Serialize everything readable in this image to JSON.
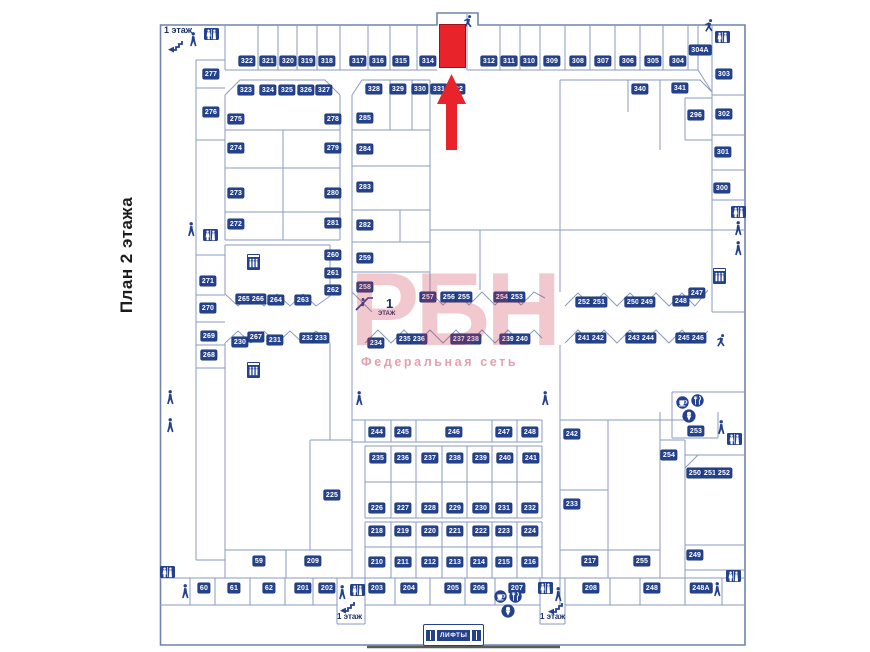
{
  "page": {
    "vertical_title": "План 2 этажа"
  },
  "watermark": {
    "logo_text": "РБН",
    "subtitle": "Федеральная сеть",
    "color": "#c92d46"
  },
  "highlight": {
    "unit_color": "#e8232a",
    "arrow_color": "#e8232a"
  },
  "label_style": {
    "bg": "#24418e",
    "fg": "#ffffff"
  },
  "lifts": {
    "label": "ЛИФТЫ"
  },
  "floor_texts": [
    {
      "t": "1 этаж",
      "x": 164,
      "y": 26,
      "size": 9
    },
    {
      "t": "1",
      "x": 386,
      "y": 297,
      "size": 13
    },
    {
      "t": "ЭТАЖ",
      "x": 378,
      "y": 311,
      "size": 6
    },
    {
      "t": "1 этаж",
      "x": 337,
      "y": 613,
      "size": 8
    },
    {
      "t": "1 этаж",
      "x": 540,
      "y": 613,
      "size": 8
    }
  ],
  "units": [
    {
      "n": "322",
      "x": 247,
      "y": 61
    },
    {
      "n": "321",
      "x": 268,
      "y": 61
    },
    {
      "n": "320",
      "x": 288,
      "y": 61
    },
    {
      "n": "319",
      "x": 307,
      "y": 61
    },
    {
      "n": "318",
      "x": 327,
      "y": 61
    },
    {
      "n": "317",
      "x": 358,
      "y": 61
    },
    {
      "n": "316",
      "x": 378,
      "y": 61
    },
    {
      "n": "315",
      "x": 401,
      "y": 61
    },
    {
      "n": "314",
      "x": 428,
      "y": 61
    },
    {
      "n": "312",
      "x": 489,
      "y": 61
    },
    {
      "n": "311",
      "x": 509,
      "y": 61
    },
    {
      "n": "310",
      "x": 529,
      "y": 61
    },
    {
      "n": "309",
      "x": 552,
      "y": 61
    },
    {
      "n": "308",
      "x": 578,
      "y": 61
    },
    {
      "n": "307",
      "x": 603,
      "y": 61
    },
    {
      "n": "306",
      "x": 628,
      "y": 61
    },
    {
      "n": "305",
      "x": 653,
      "y": 61
    },
    {
      "n": "304",
      "x": 678,
      "y": 61
    },
    {
      "n": "304A",
      "x": 700,
      "y": 50
    },
    {
      "n": "323",
      "x": 246,
      "y": 90
    },
    {
      "n": "324",
      "x": 268,
      "y": 90
    },
    {
      "n": "325",
      "x": 287,
      "y": 90
    },
    {
      "n": "326",
      "x": 306,
      "y": 90
    },
    {
      "n": "327",
      "x": 324,
      "y": 90
    },
    {
      "n": "328",
      "x": 374,
      "y": 89
    },
    {
      "n": "329",
      "x": 398,
      "y": 89
    },
    {
      "n": "330",
      "x": 420,
      "y": 89
    },
    {
      "n": "331",
      "x": 439,
      "y": 89
    },
    {
      "n": "332",
      "x": 457,
      "y": 89
    },
    {
      "n": "340",
      "x": 640,
      "y": 89
    },
    {
      "n": "341",
      "x": 680,
      "y": 88
    },
    {
      "n": "303",
      "x": 724,
      "y": 74
    },
    {
      "n": "302",
      "x": 724,
      "y": 114
    },
    {
      "n": "296",
      "x": 696,
      "y": 115
    },
    {
      "n": "301",
      "x": 723,
      "y": 152
    },
    {
      "n": "300",
      "x": 722,
      "y": 188
    },
    {
      "n": "277",
      "x": 211,
      "y": 74
    },
    {
      "n": "276",
      "x": 211,
      "y": 112
    },
    {
      "n": "275",
      "x": 236,
      "y": 119
    },
    {
      "n": "274",
      "x": 236,
      "y": 148
    },
    {
      "n": "273",
      "x": 236,
      "y": 193
    },
    {
      "n": "272",
      "x": 236,
      "y": 224
    },
    {
      "n": "278",
      "x": 333,
      "y": 119
    },
    {
      "n": "279",
      "x": 333,
      "y": 148
    },
    {
      "n": "280",
      "x": 333,
      "y": 193
    },
    {
      "n": "281",
      "x": 333,
      "y": 223
    },
    {
      "n": "285",
      "x": 365,
      "y": 118
    },
    {
      "n": "284",
      "x": 365,
      "y": 149
    },
    {
      "n": "283",
      "x": 365,
      "y": 187
    },
    {
      "n": "282",
      "x": 365,
      "y": 225
    },
    {
      "n": "259",
      "x": 365,
      "y": 258
    },
    {
      "n": "258",
      "x": 365,
      "y": 287
    },
    {
      "n": "260",
      "x": 333,
      "y": 255
    },
    {
      "n": "261",
      "x": 333,
      "y": 273
    },
    {
      "n": "262",
      "x": 333,
      "y": 290
    },
    {
      "n": "271",
      "x": 208,
      "y": 281
    },
    {
      "n": "270",
      "x": 208,
      "y": 308
    },
    {
      "n": "269",
      "x": 209,
      "y": 336
    },
    {
      "n": "268",
      "x": 209,
      "y": 355
    },
    {
      "n": "265",
      "x": 244,
      "y": 299
    },
    {
      "n": "266",
      "x": 258,
      "y": 299
    },
    {
      "n": "264",
      "x": 276,
      "y": 300
    },
    {
      "n": "263",
      "x": 303,
      "y": 300
    },
    {
      "n": "257",
      "x": 428,
      "y": 297
    },
    {
      "n": "256",
      "x": 449,
      "y": 297
    },
    {
      "n": "255",
      "x": 464,
      "y": 297
    },
    {
      "n": "254",
      "x": 502,
      "y": 297
    },
    {
      "n": "253",
      "x": 517,
      "y": 297
    },
    {
      "n": "252",
      "x": 584,
      "y": 302
    },
    {
      "n": "251",
      "x": 599,
      "y": 302
    },
    {
      "n": "250",
      "x": 633,
      "y": 302
    },
    {
      "n": "249",
      "x": 647,
      "y": 302
    },
    {
      "n": "248",
      "x": 681,
      "y": 301
    },
    {
      "n": "247",
      "x": 697,
      "y": 293
    },
    {
      "n": "241",
      "x": 584,
      "y": 338
    },
    {
      "n": "242",
      "x": 598,
      "y": 338
    },
    {
      "n": "243",
      "x": 634,
      "y": 338
    },
    {
      "n": "244",
      "x": 648,
      "y": 338
    },
    {
      "n": "245",
      "x": 684,
      "y": 338
    },
    {
      "n": "246",
      "x": 698,
      "y": 338
    },
    {
      "n": "230",
      "x": 240,
      "y": 342
    },
    {
      "n": "267",
      "x": 256,
      "y": 337
    },
    {
      "n": "231",
      "x": 275,
      "y": 340
    },
    {
      "n": "232",
      "x": 308,
      "y": 338
    },
    {
      "n": "233",
      "x": 321,
      "y": 338
    },
    {
      "n": "234",
      "x": 376,
      "y": 343
    },
    {
      "n": "235",
      "x": 405,
      "y": 339
    },
    {
      "n": "236",
      "x": 419,
      "y": 339
    },
    {
      "n": "237",
      "x": 459,
      "y": 339
    },
    {
      "n": "238",
      "x": 473,
      "y": 339
    },
    {
      "n": "239",
      "x": 508,
      "y": 339
    },
    {
      "n": "240",
      "x": 522,
      "y": 339
    },
    {
      "n": "242",
      "x": 572,
      "y": 434
    },
    {
      "n": "233",
      "x": 572,
      "y": 504
    },
    {
      "n": "217",
      "x": 590,
      "y": 561
    },
    {
      "n": "254",
      "x": 669,
      "y": 455
    },
    {
      "n": "255",
      "x": 642,
      "y": 561
    },
    {
      "n": "253",
      "x": 696,
      "y": 431
    },
    {
      "n": "250",
      "x": 695,
      "y": 473
    },
    {
      "n": "251",
      "x": 710,
      "y": 473
    },
    {
      "n": "252",
      "x": 724,
      "y": 473
    },
    {
      "n": "249",
      "x": 695,
      "y": 555
    },
    {
      "n": "244",
      "x": 377,
      "y": 432
    },
    {
      "n": "245",
      "x": 403,
      "y": 432
    },
    {
      "n": "246",
      "x": 454,
      "y": 432
    },
    {
      "n": "247",
      "x": 504,
      "y": 432
    },
    {
      "n": "248",
      "x": 530,
      "y": 432
    },
    {
      "n": "235",
      "x": 378,
      "y": 458
    },
    {
      "n": "236",
      "x": 403,
      "y": 458
    },
    {
      "n": "237",
      "x": 430,
      "y": 458
    },
    {
      "n": "238",
      "x": 455,
      "y": 458
    },
    {
      "n": "239",
      "x": 481,
      "y": 458
    },
    {
      "n": "240",
      "x": 505,
      "y": 458
    },
    {
      "n": "241",
      "x": 531,
      "y": 458
    },
    {
      "n": "226",
      "x": 377,
      "y": 508
    },
    {
      "n": "227",
      "x": 403,
      "y": 508
    },
    {
      "n": "228",
      "x": 430,
      "y": 508
    },
    {
      "n": "229",
      "x": 455,
      "y": 508
    },
    {
      "n": "230",
      "x": 481,
      "y": 508
    },
    {
      "n": "231",
      "x": 504,
      "y": 508
    },
    {
      "n": "232",
      "x": 530,
      "y": 508
    },
    {
      "n": "218",
      "x": 377,
      "y": 531
    },
    {
      "n": "219",
      "x": 403,
      "y": 531
    },
    {
      "n": "220",
      "x": 430,
      "y": 531
    },
    {
      "n": "221",
      "x": 455,
      "y": 531
    },
    {
      "n": "222",
      "x": 481,
      "y": 531
    },
    {
      "n": "223",
      "x": 504,
      "y": 531
    },
    {
      "n": "224",
      "x": 530,
      "y": 531
    },
    {
      "n": "210",
      "x": 377,
      "y": 562
    },
    {
      "n": "211",
      "x": 403,
      "y": 562
    },
    {
      "n": "212",
      "x": 430,
      "y": 562
    },
    {
      "n": "213",
      "x": 455,
      "y": 562
    },
    {
      "n": "214",
      "x": 479,
      "y": 562
    },
    {
      "n": "215",
      "x": 504,
      "y": 562
    },
    {
      "n": "216",
      "x": 530,
      "y": 562
    },
    {
      "n": "225",
      "x": 332,
      "y": 495
    },
    {
      "n": "59",
      "x": 259,
      "y": 561
    },
    {
      "n": "209",
      "x": 313,
      "y": 561
    },
    {
      "n": "60",
      "x": 204,
      "y": 588
    },
    {
      "n": "61",
      "x": 234,
      "y": 588
    },
    {
      "n": "62",
      "x": 269,
      "y": 588
    },
    {
      "n": "201",
      "x": 303,
      "y": 588
    },
    {
      "n": "202",
      "x": 327,
      "y": 588
    },
    {
      "n": "203",
      "x": 377,
      "y": 588
    },
    {
      "n": "204",
      "x": 409,
      "y": 588
    },
    {
      "n": "205",
      "x": 453,
      "y": 588
    },
    {
      "n": "206",
      "x": 479,
      "y": 588
    },
    {
      "n": "207",
      "x": 517,
      "y": 588
    },
    {
      "n": "208",
      "x": 591,
      "y": 588
    },
    {
      "n": "248",
      "x": 652,
      "y": 588
    },
    {
      "n": "248A",
      "x": 701,
      "y": 588
    }
  ],
  "icons": [
    {
      "t": "stairs",
      "x": 167,
      "y": 40
    },
    {
      "t": "person",
      "x": 188,
      "y": 32
    },
    {
      "t": "wc",
      "x": 204,
      "y": 28
    },
    {
      "t": "runner",
      "x": 462,
      "y": 15
    },
    {
      "t": "runner",
      "x": 703,
      "y": 19
    },
    {
      "t": "wc",
      "x": 715,
      "y": 31
    },
    {
      "t": "wc",
      "x": 731,
      "y": 206
    },
    {
      "t": "person",
      "x": 733,
      "y": 221
    },
    {
      "t": "person",
      "x": 733,
      "y": 241
    },
    {
      "t": "elevator",
      "x": 713,
      "y": 268
    },
    {
      "t": "person",
      "x": 186,
      "y": 222
    },
    {
      "t": "wc",
      "x": 203,
      "y": 229
    },
    {
      "t": "person",
      "x": 165,
      "y": 390
    },
    {
      "t": "person",
      "x": 165,
      "y": 418
    },
    {
      "t": "elevator",
      "x": 247,
      "y": 254
    },
    {
      "t": "elevator",
      "x": 247,
      "y": 362
    },
    {
      "t": "escalator",
      "x": 355,
      "y": 294
    },
    {
      "t": "person",
      "x": 354,
      "y": 391
    },
    {
      "t": "person",
      "x": 540,
      "y": 391
    },
    {
      "t": "runner",
      "x": 715,
      "y": 334
    },
    {
      "t": "food-cup",
      "x": 676,
      "y": 396
    },
    {
      "t": "food-restaurant",
      "x": 691,
      "y": 394
    },
    {
      "t": "food-snack",
      "x": 682,
      "y": 409
    },
    {
      "t": "person",
      "x": 716,
      "y": 420
    },
    {
      "t": "wc",
      "x": 727,
      "y": 433
    },
    {
      "t": "wc",
      "x": 160,
      "y": 566
    },
    {
      "t": "person",
      "x": 180,
      "y": 584
    },
    {
      "t": "person",
      "x": 337,
      "y": 585
    },
    {
      "t": "wc",
      "x": 350,
      "y": 584
    },
    {
      "t": "stairs",
      "x": 339,
      "y": 601
    },
    {
      "t": "food-cup",
      "x": 494,
      "y": 590
    },
    {
      "t": "food-restaurant",
      "x": 509,
      "y": 590
    },
    {
      "t": "food-snack",
      "x": 501,
      "y": 604
    },
    {
      "t": "wc",
      "x": 538,
      "y": 582
    },
    {
      "t": "person",
      "x": 553,
      "y": 587
    },
    {
      "t": "stairs",
      "x": 547,
      "y": 602
    },
    {
      "t": "person",
      "x": 712,
      "y": 582
    },
    {
      "t": "wc",
      "x": 726,
      "y": 570
    }
  ]
}
